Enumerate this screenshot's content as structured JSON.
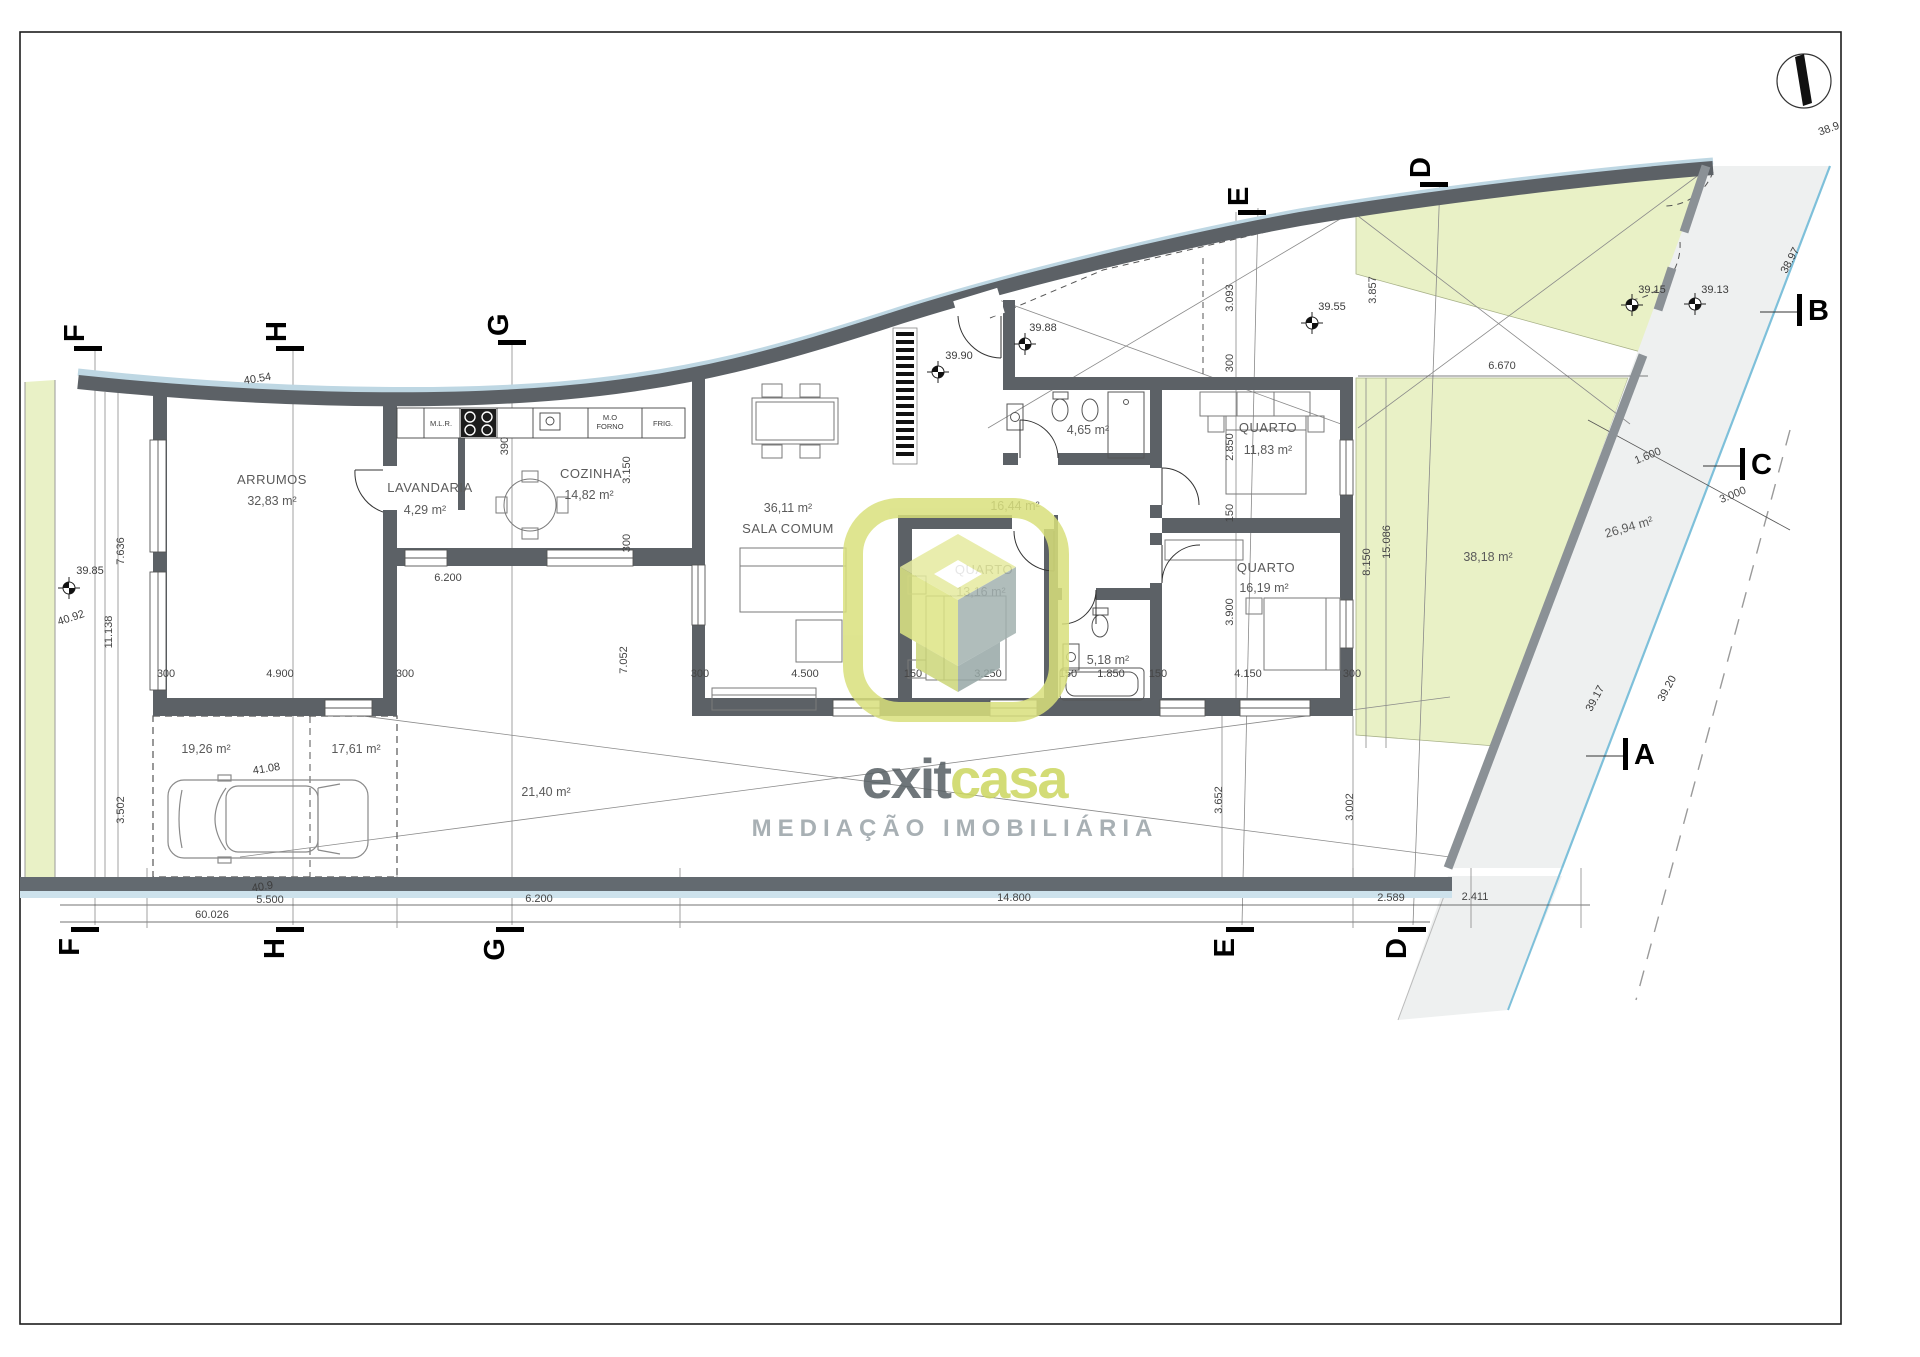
{
  "plan": {
    "room_labels": [
      {
        "text": "ARRUMOS",
        "x": 272,
        "y": 484,
        "cls": "room"
      },
      {
        "text": "32,83 m²",
        "x": 272,
        "y": 505,
        "cls": "area"
      },
      {
        "text": "LAVANDARIA",
        "x": 430,
        "y": 492,
        "cls": "room"
      },
      {
        "text": "4,29 m²",
        "x": 425,
        "y": 514,
        "cls": "area"
      },
      {
        "text": "COZINHA",
        "x": 591,
        "y": 478,
        "cls": "room"
      },
      {
        "text": "14,82 m²",
        "x": 589,
        "y": 499,
        "cls": "area"
      },
      {
        "text": "36,11 m²",
        "x": 788,
        "y": 512,
        "cls": "area"
      },
      {
        "text": "SALA COMUM",
        "x": 788,
        "y": 533,
        "cls": "room"
      },
      {
        "text": "QUARTO",
        "x": 984,
        "y": 574,
        "cls": "room"
      },
      {
        "text": "13,16 m²",
        "x": 981,
        "y": 596,
        "cls": "area"
      },
      {
        "text": "QUARTO",
        "x": 1268,
        "y": 432,
        "cls": "room"
      },
      {
        "text": "11,83 m²",
        "x": 1268,
        "y": 454,
        "cls": "area"
      },
      {
        "text": "QUARTO",
        "x": 1266,
        "y": 572,
        "cls": "room"
      },
      {
        "text": "16,19 m²",
        "x": 1264,
        "y": 592,
        "cls": "area"
      },
      {
        "text": "4,65 m²",
        "x": 1088,
        "y": 434,
        "cls": "area"
      },
      {
        "text": "5,18 m²",
        "x": 1108,
        "y": 664,
        "cls": "area"
      },
      {
        "text": "16,44 m²",
        "x": 1015,
        "y": 510,
        "cls": "area"
      }
    ],
    "outdoor_labels": [
      {
        "text": "19,26 m²",
        "x": 206,
        "y": 753,
        "rot": 0
      },
      {
        "text": "17,61 m²",
        "x": 356,
        "y": 753,
        "rot": 0
      },
      {
        "text": "21,40 m²",
        "x": 546,
        "y": 796,
        "rot": 0
      },
      {
        "text": "38,18 m²",
        "x": 1488,
        "y": 561,
        "rot": 0
      },
      {
        "text": "26,94 m²",
        "x": 1630,
        "y": 531,
        "rot": -16
      }
    ],
    "appliance_labels": [
      {
        "text": "M.L.R.",
        "x": 441,
        "y": 426
      },
      {
        "text": "M.O",
        "x": 610,
        "y": 420
      },
      {
        "text": "FORNO",
        "x": 610,
        "y": 429
      },
      {
        "text": "FRIG.",
        "x": 663,
        "y": 426
      }
    ],
    "dimension_labels": [
      {
        "text": "7.636",
        "x": 124,
        "y": 551,
        "rot": -90
      },
      {
        "text": "11.138",
        "x": 112,
        "y": 632,
        "rot": -90
      },
      {
        "text": "3.502",
        "x": 124,
        "y": 810,
        "rot": -90
      },
      {
        "text": "300",
        "x": 166,
        "y": 677,
        "rot": 0
      },
      {
        "text": "4.900",
        "x": 280,
        "y": 677,
        "rot": 0
      },
      {
        "text": "300",
        "x": 405,
        "y": 677,
        "rot": 0
      },
      {
        "text": "6.200",
        "x": 448,
        "y": 581,
        "rot": 0
      },
      {
        "text": "390",
        "x": 508,
        "y": 446,
        "rot": -90
      },
      {
        "text": "3.150",
        "x": 630,
        "y": 470,
        "rot": -90
      },
      {
        "text": "300",
        "x": 630,
        "y": 543,
        "rot": -90
      },
      {
        "text": "7.052",
        "x": 627,
        "y": 660,
        "rot": -90
      },
      {
        "text": "300",
        "x": 700,
        "y": 677,
        "rot": 0
      },
      {
        "text": "4.500",
        "x": 805,
        "y": 677,
        "rot": 0
      },
      {
        "text": "150",
        "x": 913,
        "y": 677,
        "rot": 0
      },
      {
        "text": "3.250",
        "x": 988,
        "y": 677,
        "rot": 0
      },
      {
        "text": "150",
        "x": 1068,
        "y": 677,
        "rot": 0
      },
      {
        "text": "1.850",
        "x": 1111,
        "y": 677,
        "rot": 0
      },
      {
        "text": "150",
        "x": 1158,
        "y": 677,
        "rot": 0
      },
      {
        "text": "4.150",
        "x": 1248,
        "y": 677,
        "rot": 0
      },
      {
        "text": "300",
        "x": 1352,
        "y": 677,
        "rot": 0
      },
      {
        "text": "3.093",
        "x": 1233,
        "y": 298,
        "rot": -90
      },
      {
        "text": "300",
        "x": 1233,
        "y": 363,
        "rot": -90
      },
      {
        "text": "2.850",
        "x": 1233,
        "y": 447,
        "rot": -90
      },
      {
        "text": "150",
        "x": 1233,
        "y": 513,
        "rot": -90
      },
      {
        "text": "3.900",
        "x": 1233,
        "y": 612,
        "rot": -90
      },
      {
        "text": "3.857",
        "x": 1376,
        "y": 290,
        "rot": -90
      },
      {
        "text": "6.670",
        "x": 1502,
        "y": 369,
        "rot": 0
      },
      {
        "text": "8.150",
        "x": 1370,
        "y": 562,
        "rot": -90
      },
      {
        "text": "15.086",
        "x": 1390,
        "y": 542,
        "rot": -90
      },
      {
        "text": "3.652",
        "x": 1222,
        "y": 800,
        "rot": -90
      },
      {
        "text": "3.002",
        "x": 1353,
        "y": 807,
        "rot": -90
      },
      {
        "text": "1.600",
        "x": 1649,
        "y": 459,
        "rot": -22
      },
      {
        "text": "3.000",
        "x": 1734,
        "y": 498,
        "rot": -22
      },
      {
        "text": "5.500",
        "x": 270,
        "y": 903,
        "rot": 0
      },
      {
        "text": "6.200",
        "x": 539,
        "y": 902,
        "rot": 0
      },
      {
        "text": "14.800",
        "x": 1014,
        "y": 901,
        "rot": 0
      },
      {
        "text": "2.589",
        "x": 1391,
        "y": 901,
        "rot": 0
      },
      {
        "text": "2.411",
        "x": 1475,
        "y": 900,
        "rot": 0
      },
      {
        "text": "60.026",
        "x": 212,
        "y": 918,
        "rot": 0
      }
    ],
    "spot_elevations": [
      {
        "text": "39.85",
        "x": 90,
        "y": 574,
        "rot": 0,
        "mx": 69,
        "my": 588
      },
      {
        "text": "40.92",
        "x": 72,
        "y": 621,
        "rot": -18,
        "mx": null,
        "my": null
      },
      {
        "text": "40.54",
        "x": 258,
        "y": 382,
        "rot": -9,
        "mx": null,
        "my": null
      },
      {
        "text": "41.08",
        "x": 267,
        "y": 772,
        "rot": -9,
        "mx": null,
        "my": null
      },
      {
        "text": "40.9",
        "x": 263,
        "y": 890,
        "rot": -9,
        "mx": null,
        "my": null
      },
      {
        "text": "39.90",
        "x": 959,
        "y": 359,
        "rot": 0,
        "mx": 938,
        "my": 372
      },
      {
        "text": "39.88",
        "x": 1043,
        "y": 331,
        "rot": 0,
        "mx": 1025,
        "my": 344
      },
      {
        "text": "39.55",
        "x": 1332,
        "y": 310,
        "rot": 0,
        "mx": 1312,
        "my": 323
      },
      {
        "text": "39.15",
        "x": 1652,
        "y": 293,
        "rot": 0,
        "mx": 1632,
        "my": 305
      },
      {
        "text": "39.13",
        "x": 1715,
        "y": 293,
        "rot": 0,
        "mx": 1695,
        "my": 304
      },
      {
        "text": "38.97",
        "x": 1793,
        "y": 262,
        "rot": -62,
        "mx": null,
        "my": null
      },
      {
        "text": "39.17",
        "x": 1598,
        "y": 700,
        "rot": -62,
        "mx": null,
        "my": null
      },
      {
        "text": "39.20",
        "x": 1670,
        "y": 690,
        "rot": -62,
        "mx": null,
        "my": null
      },
      {
        "text": "38.9",
        "x": 1830,
        "y": 132,
        "rot": -20,
        "mx": null,
        "my": null
      }
    ],
    "section_markers": {
      "top": [
        {
          "letter": "F",
          "x": 88,
          "y": 348
        },
        {
          "letter": "H",
          "x": 290,
          "y": 348
        },
        {
          "letter": "G",
          "x": 512,
          "y": 342
        },
        {
          "letter": "E",
          "x": 1252,
          "y": 212
        },
        {
          "letter": "D",
          "x": 1434,
          "y": 184
        }
      ],
      "bottom": [
        {
          "letter": "F",
          "x": 85,
          "y": 930
        },
        {
          "letter": "H",
          "x": 290,
          "y": 930
        },
        {
          "letter": "G",
          "x": 510,
          "y": 930
        },
        {
          "letter": "E",
          "x": 1240,
          "y": 930
        },
        {
          "letter": "D",
          "x": 1412,
          "y": 930
        }
      ],
      "right": [
        {
          "letter": "B",
          "x": 1800,
          "y": 310
        },
        {
          "letter": "C",
          "x": 1743,
          "y": 464
        },
        {
          "letter": "A",
          "x": 1626,
          "y": 754
        }
      ]
    }
  },
  "watermark": {
    "brand_left": "exit",
    "brand_right": "casa",
    "subtitle": "MEDIAÇÃO IMOBILIÁRIA"
  },
  "colors": {
    "wall": "#5c6166",
    "green": "#e9f1c6",
    "road_fill": "#eef0f0",
    "road_blue": "#7ec0da",
    "band_blue": "#bed7e3",
    "logo_yellow": "#d9e07c",
    "logo_gray": "#a3b2b0"
  }
}
